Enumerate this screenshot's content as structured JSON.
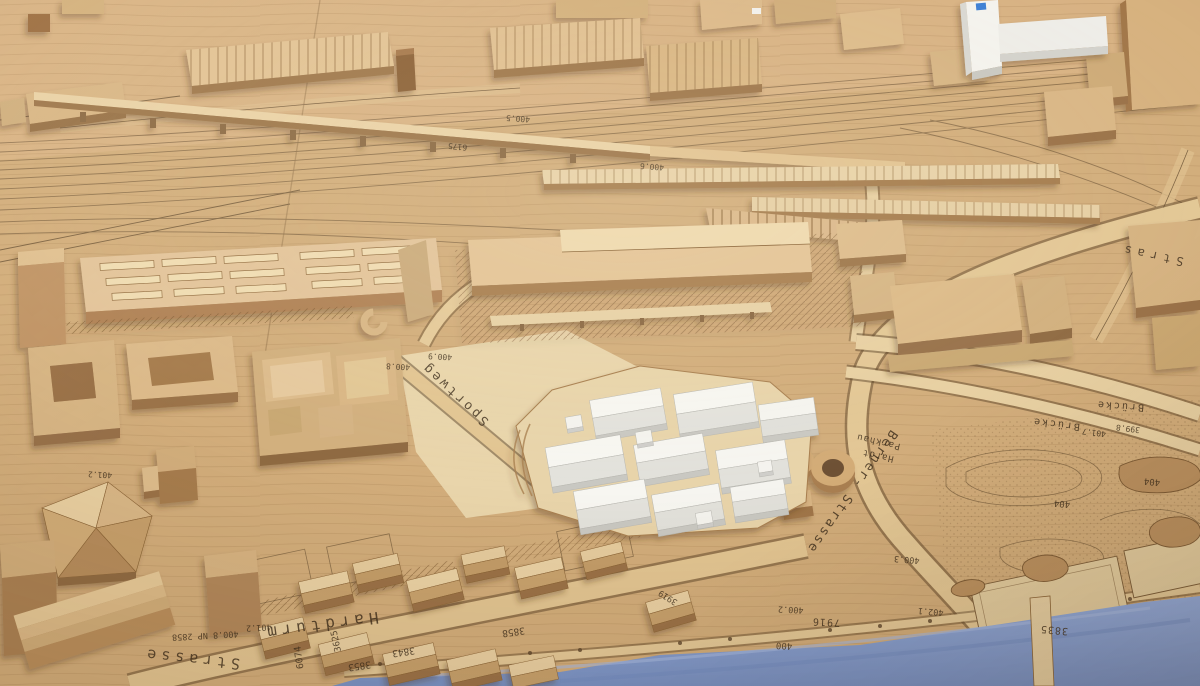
{
  "scene": {
    "subject": "Wooden architectural scale model of a city district with engraved cadastral map, railway yards, a white proposed development of gabled blocks, two cylindrical parking silos and a blue river",
    "colors": {
      "wood_base": "#d2ad7b",
      "wood_light": "#ecd9b0",
      "wood_mid": "#d9b685",
      "wood_dark": "#9a7146",
      "white_model": "#f4f3ee",
      "white_shade": "#d9d8d2",
      "water": "#83a0d2",
      "ink": "#43311d",
      "logo_blue": "#3d7fd4"
    }
  },
  "labels": {
    "streets": {
      "hardturm": "Hardturm",
      "strasse": "Strasse",
      "sportweg": "Sportweg",
      "berner_strasse": "Berner- Strasse",
      "bruecke_1": "Brücke",
      "bruecke_2": "Brücke",
      "stras_fragment": "Stras"
    },
    "places": {
      "parkhaus_line1": "Parkhau",
      "parkhaus_line2": "Hardt"
    },
    "parcels": {
      "p3843": "3843",
      "p3858": "3858",
      "p3853": "3853",
      "p3625": "3625",
      "p6074": "6074",
      "p3919": "3919",
      "p7916": "7916",
      "p3835": "3835",
      "np2858": "400.8 NP 2858"
    },
    "elevations": {
      "e401_2": "401.2",
      "e401_2b": "401.2",
      "e400_8": "400.8",
      "e400_9": "400.9",
      "e400_2": "400.2",
      "e400": "400",
      "e400_3": "400.3",
      "e402_1": "402.1",
      "e401_7": "401.7",
      "e399_8": "399.8",
      "e404": "404",
      "e6175": "6175",
      "e400_5": "400.5",
      "e400_6": "400.6"
    }
  }
}
